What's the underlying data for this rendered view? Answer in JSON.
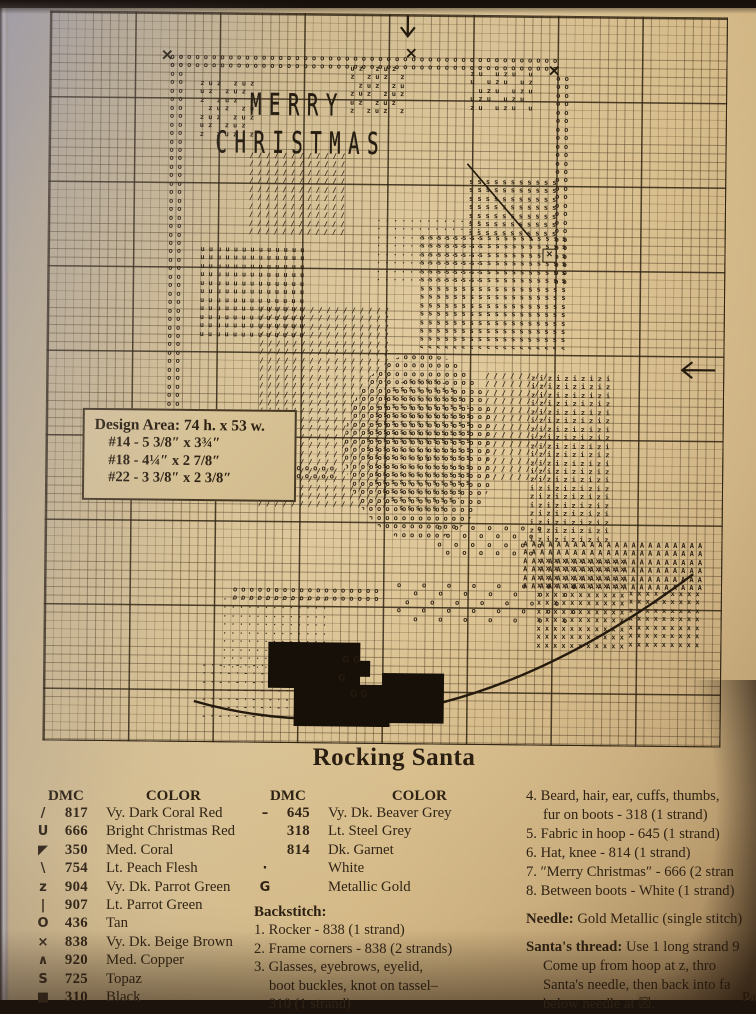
{
  "page": {
    "title": "Rocking Santa",
    "design_area": {
      "heading": "Design Area:",
      "dims": "74 h. x 53 w.",
      "sizes": [
        "#14  - 5 3/8″ x 3¾″",
        "#18  - 4¼″ x 2 7/8″",
        "#22  - 3 3/8″ x 2 3/8″"
      ]
    },
    "fragment_bottom_right": "Pa"
  },
  "chart": {
    "stitched_words": {
      "line1": "MERRY",
      "line2": "CHRISTMAS"
    },
    "regions": [
      {
        "n": "hoop-frame-top",
        "p": "o",
        "x": 120,
        "y": 40,
        "w": 400,
        "h": 18
      },
      {
        "n": "hoop-frame-left",
        "p": "o",
        "x": 120,
        "y": 40,
        "w": 17,
        "h": 424
      },
      {
        "n": "hoop-frame-right",
        "p": "o",
        "x": 506,
        "y": 58,
        "w": 17,
        "h": 210
      },
      {
        "n": "hoop-frame-bottom",
        "p": "o",
        "x": 84,
        "y": 450,
        "w": 210,
        "h": 17
      },
      {
        "n": "holly-left",
        "p": "zuz ",
        "x": 150,
        "y": 66,
        "w": 62,
        "h": 58
      },
      {
        "n": "holly-mid",
        "p": "uz z",
        "x": 300,
        "y": 50,
        "w": 60,
        "h": 52
      },
      {
        "n": "holly-right",
        "p": "zu u",
        "x": 420,
        "y": 54,
        "w": 64,
        "h": 40
      },
      {
        "n": "santa-hat",
        "p": "/",
        "x": 200,
        "y": 138,
        "w": 100,
        "h": 88
      },
      {
        "n": "santa-face",
        "p": "·",
        "x": 328,
        "y": 202,
        "w": 108,
        "h": 66
      },
      {
        "n": "santa-beard",
        "p": "s",
        "x": 372,
        "y": 218,
        "w": 155,
        "h": 115
      },
      {
        "n": "santa-arm-raised",
        "p": "s",
        "x": 420,
        "y": 162,
        "w": 90,
        "h": 60
      },
      {
        "n": "santa-sleeve",
        "p": "u",
        "x": 152,
        "y": 232,
        "w": 112,
        "h": 92
      },
      {
        "n": "santa-suit",
        "p": "/",
        "x": 212,
        "y": 292,
        "w": 135,
        "h": 205
      },
      {
        "n": "hand-hoop-ring",
        "p": "o",
        "x": 298,
        "y": 338,
        "w": 152,
        "h": 188,
        "r": 1
      },
      {
        "n": "hand-hoop-fabric",
        "p": "s",
        "x": 320,
        "y": 362,
        "w": 112,
        "h": 138,
        "r": 1
      },
      {
        "n": "hand-hoop-dashes",
        "p": "-",
        "x": 338,
        "y": 390,
        "w": 80,
        "h": 56,
        "r": 1
      },
      {
        "n": "santa-knee",
        "p": "/",
        "x": 438,
        "y": 356,
        "w": 64,
        "h": 112
      },
      {
        "n": "striped-stockings",
        "p": "zi",
        "x": 484,
        "y": 358,
        "w": 88,
        "h": 168
      },
      {
        "n": "boot-left",
        "p": "x",
        "x": 492,
        "y": 540,
        "w": 94,
        "h": 92
      },
      {
        "n": "boot-right",
        "p": "x",
        "x": 584,
        "y": 572,
        "w": 78,
        "h": 62
      },
      {
        "n": "rocker-copper",
        "p": "A",
        "x": 478,
        "y": 524,
        "w": 184,
        "h": 48
      },
      {
        "n": "chair-spindles",
        "p": "o ",
        "x": 392,
        "y": 508,
        "w": 112,
        "h": 34
      },
      {
        "n": "white-fur-mound",
        "p": "·",
        "x": 178,
        "y": 582,
        "w": 112,
        "h": 72
      },
      {
        "n": "white-dash-patch",
        "p": "-·",
        "x": 158,
        "y": 648,
        "w": 112,
        "h": 62
      },
      {
        "n": "o-strip",
        "p": "o",
        "x": 188,
        "y": 572,
        "w": 150,
        "h": 20
      },
      {
        "n": "o-scatter",
        "p": "o  ",
        "x": 352,
        "y": 566,
        "w": 185,
        "h": 46
      }
    ],
    "solids": [
      {
        "x": 224,
        "y": 628,
        "w": 92,
        "h": 46
      },
      {
        "x": 250,
        "y": 670,
        "w": 96,
        "h": 42
      },
      {
        "x": 338,
        "y": 658,
        "w": 62,
        "h": 50
      },
      {
        "x": 300,
        "y": 646,
        "w": 26,
        "h": 16
      }
    ],
    "corner_marks": [
      {
        "g": "×",
        "x": 110,
        "y": 34,
        "s": 16
      },
      {
        "g": "×",
        "x": 354,
        "y": 30,
        "s": 16
      },
      {
        "g": "×",
        "x": 497,
        "y": 46,
        "s": 16
      },
      {
        "g": "×",
        "x": 104,
        "y": 450,
        "s": 16
      },
      {
        "g": "G G",
        "x": 298,
        "y": 642,
        "s": 9
      },
      {
        "g": "G",
        "x": 294,
        "y": 660,
        "s": 9
      },
      {
        "g": "G G",
        "x": 306,
        "y": 676,
        "s": 9
      }
    ]
  },
  "key": {
    "col1": {
      "dmc_header": "DMC",
      "color_header": "COLOR",
      "rows": [
        {
          "sym": "/",
          "dmc": "817",
          "name": "Vy. Dark Coral Red"
        },
        {
          "sym": "U",
          "dmc": "666",
          "name": "Bright Christmas Red"
        },
        {
          "sym": "◤",
          "dmc": "350",
          "name": "Med. Coral"
        },
        {
          "sym": "\\",
          "dmc": "754",
          "name": "Lt. Peach Flesh"
        },
        {
          "sym": "z",
          "dmc": "904",
          "name": "Vy. Dk. Parrot Green"
        },
        {
          "sym": "|",
          "dmc": "907",
          "name": "Lt. Parrot Green"
        },
        {
          "sym": "O",
          "dmc": "436",
          "name": "Tan"
        },
        {
          "sym": "×",
          "dmc": "838",
          "name": "Vy. Dk. Beige Brown"
        },
        {
          "sym": "∧",
          "dmc": "920",
          "name": "Med. Copper"
        },
        {
          "sym": "S",
          "dmc": "725",
          "name": "Topaz"
        },
        {
          "sym": "■",
          "dmc": "310",
          "name": "Black"
        }
      ]
    },
    "col2": {
      "dmc_header": "DMC",
      "color_header": "COLOR",
      "rows": [
        {
          "sym": "–",
          "dmc": "645",
          "name": "Vy. Dk. Beaver Grey"
        },
        {
          "sym": "",
          "dmc": "318",
          "name": "Lt. Steel Grey"
        },
        {
          "sym": "",
          "dmc": "814",
          "name": "Dk. Garnet"
        },
        {
          "sym": "·",
          "dmc": "",
          "name": "White"
        },
        {
          "sym": "G",
          "dmc": "",
          "name": "Metallic Gold"
        }
      ]
    }
  },
  "backstitch": {
    "heading": "Backstitch:",
    "items": [
      {
        "lines": [
          "1. Rocker - 838 (1 strand)"
        ]
      },
      {
        "lines": [
          "2. Frame corners - 838 (2 strands)"
        ]
      },
      {
        "lines": [
          "3. Glasses, eyebrows, eyelid,",
          "boot buckles, knot on tassel–",
          "310 (1 strand)"
        ]
      }
    ]
  },
  "instructions": {
    "items": [
      {
        "lines": [
          "4. Beard, hair, ear, cuffs, thumbs,",
          "fur on boots - 318 (1 strand)"
        ]
      },
      {
        "lines": [
          "5. Fabric in hoop - 645 (1 strand)"
        ]
      },
      {
        "lines": [
          "6. Hat, knee - 814 (1 strand)"
        ]
      },
      {
        "lines": [
          "7. ″Merry Christmas″ - 666 (2 stran"
        ]
      },
      {
        "lines": [
          "8. Between boots - White (1 strand)"
        ]
      }
    ],
    "needle": {
      "label": "Needle:",
      "text": " Gold Metallic (single stitch)"
    },
    "santas_thread": {
      "label": "Santa's thread:",
      "first": " Use 1 long strand 9",
      "lines": [
        "Come up from hoop at z, thro",
        "Santa's needle, then back into fa",
        "below needle at ☒."
      ]
    }
  }
}
